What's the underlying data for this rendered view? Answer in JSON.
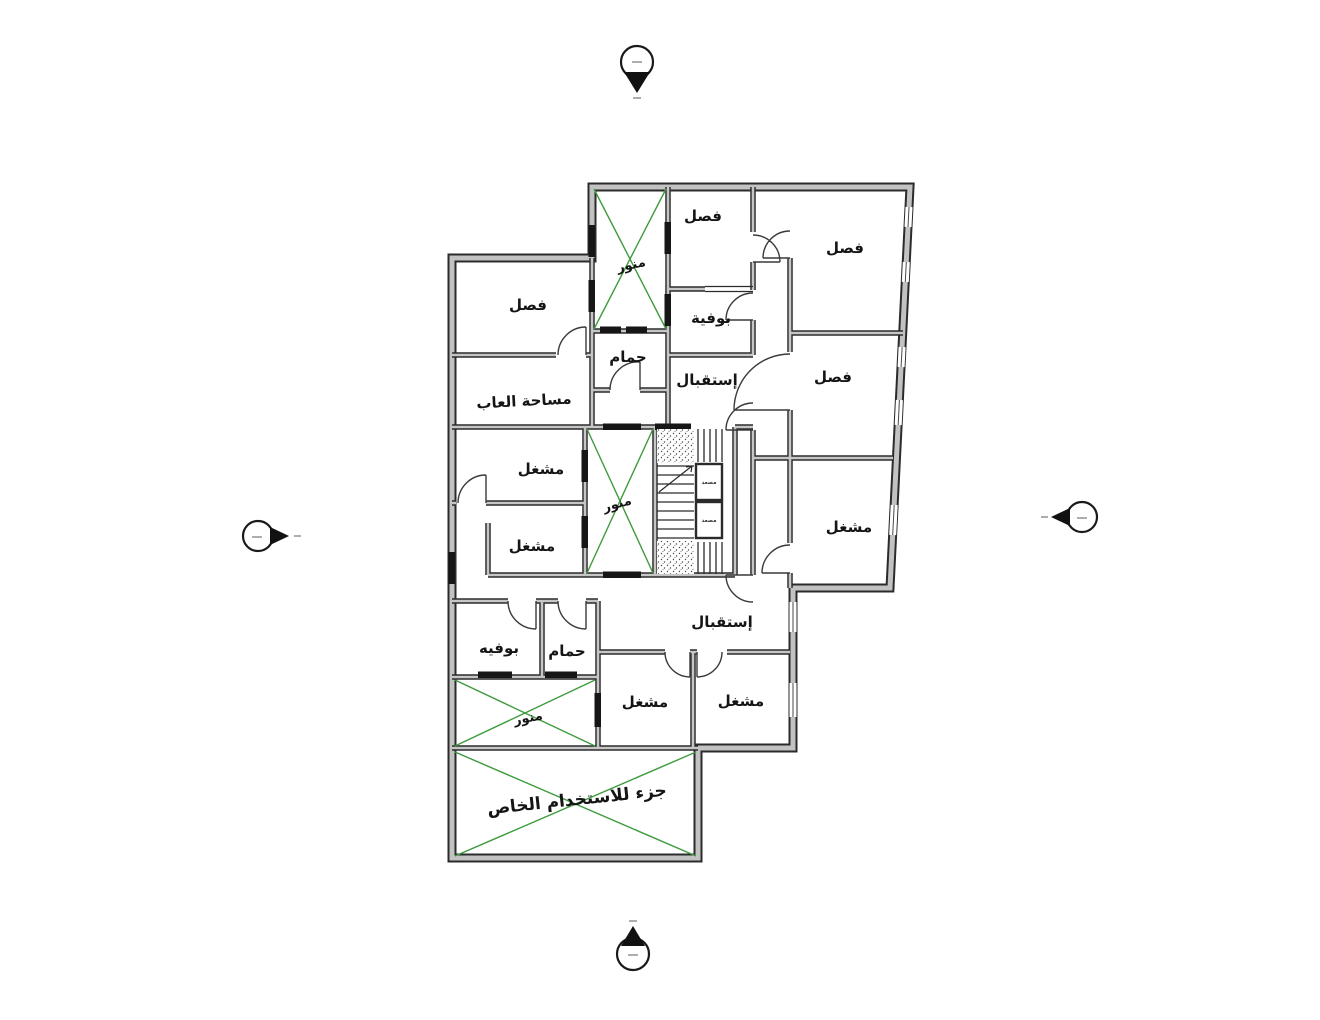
{
  "drawing": {
    "type": "architectural-floor-plan",
    "language": "ar"
  },
  "colors": {
    "wall_edge": "#2b2b2b",
    "wall_fill": "#c2c2c2",
    "light_well_green": "#3d9b3d",
    "label_text": "#151515",
    "background": "#ffffff"
  },
  "rooms": [
    {
      "id": "classroom-top-left",
      "label": "فصل"
    },
    {
      "id": "light-well-top",
      "label": "منور"
    },
    {
      "id": "classroom-top-middle",
      "label": "فصل"
    },
    {
      "id": "classroom-top-right",
      "label": "فصل"
    },
    {
      "id": "buffet-upper",
      "label": "بوفية"
    },
    {
      "id": "bathroom-upper",
      "label": "حمام"
    },
    {
      "id": "reception-upper",
      "label": "إستقبال"
    },
    {
      "id": "classroom-right",
      "label": "فصل"
    },
    {
      "id": "play-area",
      "label": "مساحة العاب"
    },
    {
      "id": "workshop-mid-left-upper",
      "label": "مشغل"
    },
    {
      "id": "workshop-mid-left-lower",
      "label": "مشغل"
    },
    {
      "id": "light-well-middle",
      "label": "منور"
    },
    {
      "id": "workshop-right",
      "label": "مشغل"
    },
    {
      "id": "reception-lower",
      "label": "إستقبال"
    },
    {
      "id": "buffet-lower",
      "label": "بوفيه"
    },
    {
      "id": "bathroom-lower",
      "label": "حمام"
    },
    {
      "id": "light-well-bottom",
      "label": "منور"
    },
    {
      "id": "workshop-bottom-left",
      "label": "مشغل"
    },
    {
      "id": "workshop-bottom-right",
      "label": "مشغل"
    },
    {
      "id": "private-use-area",
      "label": "جزء للاستخدام الخاص"
    }
  ],
  "elevators": [
    {
      "label": "مصعد"
    },
    {
      "label": "مصعد"
    }
  ]
}
